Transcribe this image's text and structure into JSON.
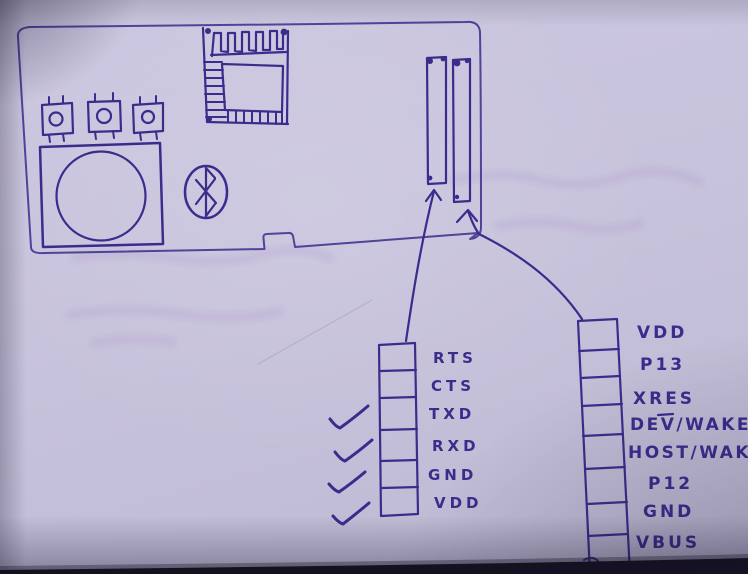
{
  "palette": {
    "ink": "#3b2c8c",
    "paper": "#c9c4dd",
    "table_edge": "#14111c"
  },
  "diagram": {
    "description_of_icons": {
      "chip": "ic-chip-sketch",
      "buttons": "push-button-sketch",
      "speaker": "speaker-sketch",
      "bluetooth": "bluetooth-logo-sketch",
      "slots": "connector-slot-sketch"
    },
    "uart_header": {
      "pins": [
        {
          "label": "RTS",
          "checked": false
        },
        {
          "label": "CTS",
          "checked": false
        },
        {
          "label": "TXD",
          "checked": true
        },
        {
          "label": "RXD",
          "checked": true
        },
        {
          "label": "GND",
          "checked": true
        },
        {
          "label": "VDD",
          "checked": true
        }
      ]
    },
    "module_header": {
      "pins": [
        {
          "label": "VDD"
        },
        {
          "label": "P13"
        },
        {
          "label": "XRES"
        },
        {
          "label": "DEV/WAKE",
          "overline": "V"
        },
        {
          "label": "HOST/WAKE"
        },
        {
          "label": "P12"
        },
        {
          "label": "GND"
        },
        {
          "label": "VBUS"
        }
      ]
    }
  }
}
